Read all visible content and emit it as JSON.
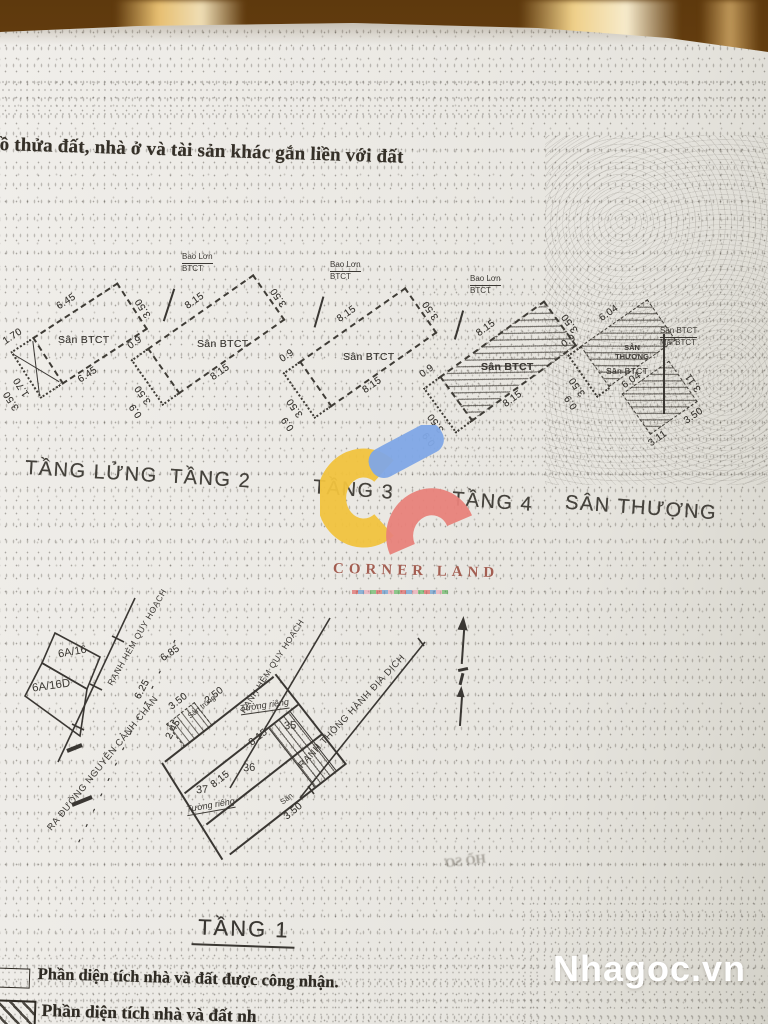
{
  "photo": {
    "surface": "wood-table",
    "watermark": "Nhagoc.vn",
    "bleed_through": "HỒ SƠ"
  },
  "document": {
    "header": "ồ thửa đất, nhà ở và tài sản khác gắn liền với đất",
    "floor_plans": [
      {
        "label": "TẦNG LỬNG",
        "area": "Sân BTCT",
        "dim_ext": "1.70",
        "dim_ext2": "1.70",
        "dim_side_a": "3.50",
        "dim_long_a": "6.45",
        "dim_long_b": "6.45",
        "dim_side_b": "3.50"
      },
      {
        "label": "TẦNG 2",
        "area": "Sân BTCT",
        "callout_1": "Bao Lơn",
        "callout_2": "BTCT",
        "dim_ext": "0.9",
        "dim_ext2": "0.9",
        "dim_side_a": "3.50",
        "dim_long_a": "8.15",
        "dim_long_b": "8.15",
        "dim_side_b": "3.50"
      },
      {
        "label": "TẦNG 3",
        "area": "Sân BTCT",
        "callout_1": "Bao Lơn",
        "callout_2": "BTCT",
        "dim_ext": "0.9",
        "dim_ext2": "0.9",
        "dim_side_a": "3.50",
        "dim_long_a": "8.15",
        "dim_long_b": "8.15",
        "dim_side_b": "3.50"
      },
      {
        "label": "TẦNG 4",
        "area": "Sân BTCT",
        "callout_1": "Bao Lơn",
        "callout_2": "BTCT",
        "dim_ext": "0.9",
        "dim_ext2": "0.9",
        "dim_side_a": "3.50",
        "dim_long_a": "8.15",
        "dim_long_b": "8.15",
        "dim_side_b": "3.50"
      },
      {
        "label": "SÂN THƯỢNG",
        "area_1": "SÂN THƯỢNG",
        "area_2": "Sân BTCT",
        "callout_1": "Sân BTCT",
        "callout_2": "Mái BTCT",
        "dim_ext": "0.9",
        "dim_ext2": "0.9",
        "dim_side_a": "3.50",
        "dim_long_a": "6.04",
        "dim_long_b": "6.04",
        "dim_small_a": "3.11",
        "dim_small_b": "3.11",
        "dim_small_side": "3.50"
      }
    ],
    "site_plan": {
      "title": "TẦNG 1",
      "parcels": [
        "6A/16",
        "6A/16D"
      ],
      "lots": [
        "35",
        "36",
        "37"
      ],
      "boundaries": {
        "hem1": "RANH HẺM QUY HOẠCH",
        "hem2": "RANH HẺM QUY HOẠCH",
        "dich": "RANH THÔNG HÀNH ĐỊA DỊCH",
        "street": "RA ĐƯỜNG NGUYỄN CẢNH CHÂN"
      },
      "walls": [
        "Tường riêng",
        "Tường riêng"
      ],
      "areas": [
        "Sân trống",
        "Sân"
      ],
      "dims": {
        "d685": "6.85",
        "d625": "6.25",
        "d350a": "3.50",
        "d250": "2.50",
        "d245": "2.45",
        "d815a": "8.15",
        "d815b": "8.15",
        "d350b": "3.50"
      }
    },
    "legend": [
      {
        "swatch": "empty",
        "text": "Phần diện tích nhà và đất được công nhận."
      },
      {
        "swatch": "hatched",
        "text": "Phần diện tích nhà và đất nh"
      }
    ]
  },
  "logo": {
    "text": "CORNER LAND"
  },
  "colors": {
    "wood": "#8a5a1e",
    "paper": "#eae8e3",
    "ink": "#393631",
    "logo_yellow": "#f1c33e",
    "logo_blue": "#7fa7e6",
    "logo_red": "#e8827a",
    "brand": "#923e2f",
    "watermark_text": "#ffffff"
  }
}
